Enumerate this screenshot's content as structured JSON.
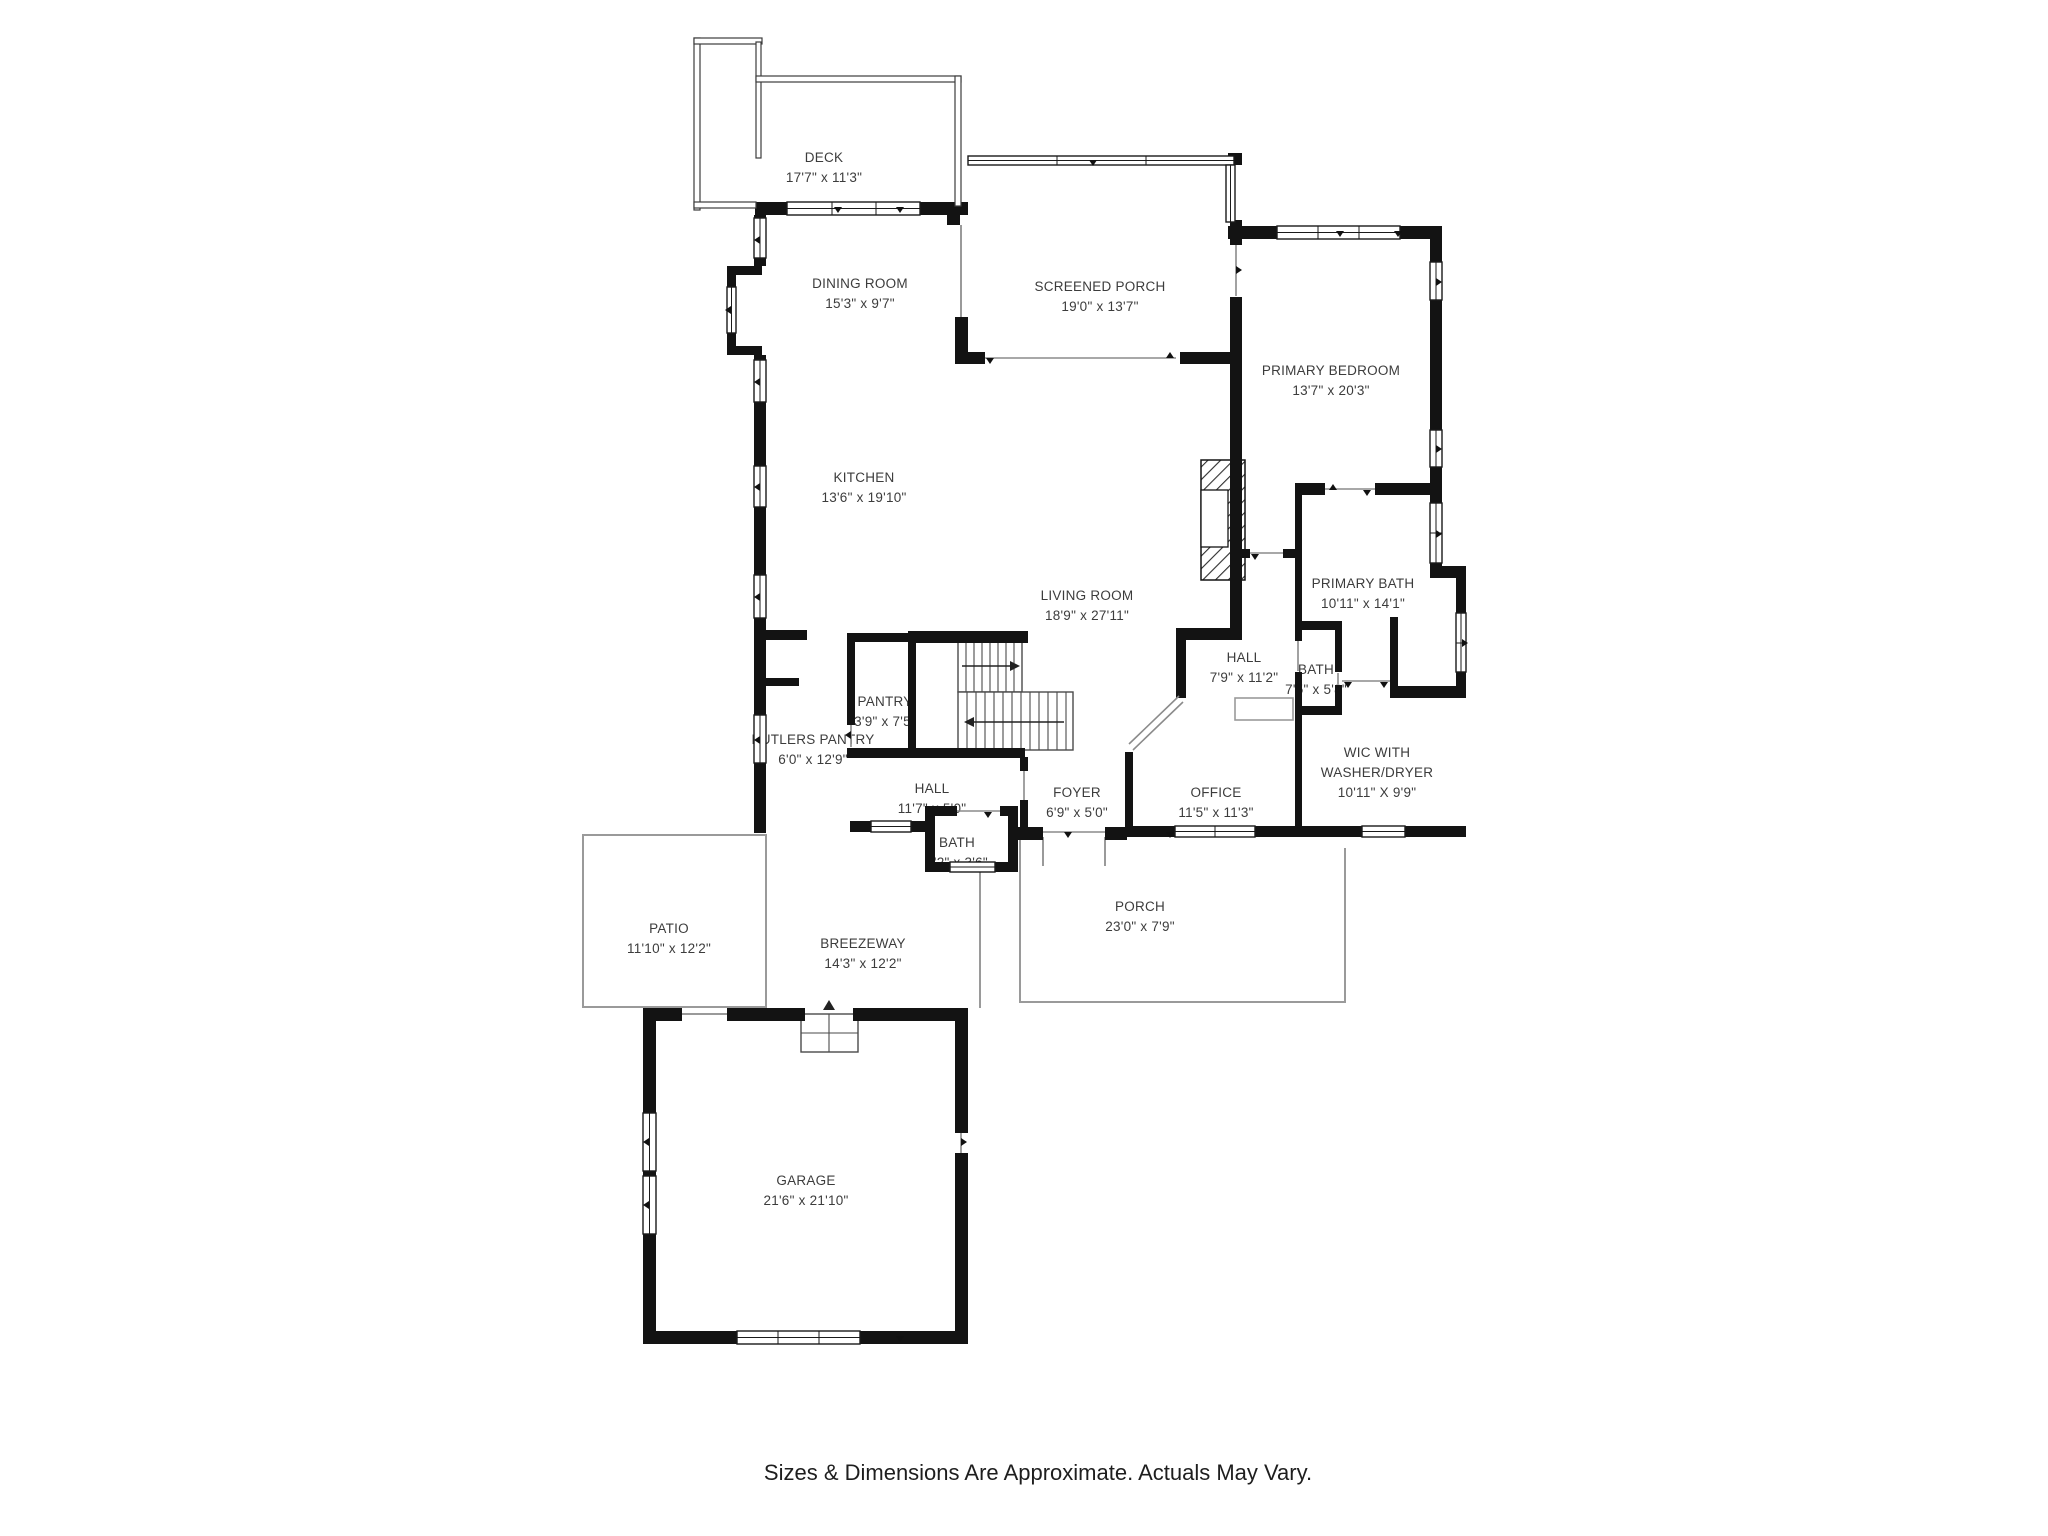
{
  "page": {
    "footer": "Sizes & Dimensions Are Approximate. Actuals May Vary.",
    "background": "#ffffff"
  },
  "colors": {
    "wall": "#131313",
    "thin_outline": "#9a9a9a",
    "label_text": "#3c3c3c",
    "footer_text": "#1e1e1e"
  },
  "rooms": [
    {
      "id": "deck",
      "label": "DECK",
      "dims": "17'7\" x 11'3\""
    },
    {
      "id": "screened-porch",
      "label": "SCREENED PORCH",
      "dims": "19'0\" x 13'7\""
    },
    {
      "id": "dining-room",
      "label": "DINING ROOM",
      "dims": "15'3\" x 9'7\""
    },
    {
      "id": "kitchen",
      "label": "KITCHEN",
      "dims": "13'6\" x 19'10\""
    },
    {
      "id": "living-room",
      "label": "LIVING ROOM",
      "dims": "18'9\" x 27'11\""
    },
    {
      "id": "primary-bedroom",
      "label": "PRIMARY BEDROOM",
      "dims": "13'7\" x 20'3\""
    },
    {
      "id": "primary-bath",
      "label": "PRIMARY BATH",
      "dims": "10'11\" x 14'1\""
    },
    {
      "id": "hall-upper",
      "label": "HALL",
      "dims": "7'9\" x 11'2\""
    },
    {
      "id": "bath-upper",
      "label": "BATH",
      "dims": "7'5\" x 5'8\""
    },
    {
      "id": "wic",
      "label": "WIC WITH",
      "label2": "WASHER/DRYER",
      "dims": "10'11\" X 9'9\""
    },
    {
      "id": "office",
      "label": "OFFICE",
      "dims": "11'5\" x 11'3\""
    },
    {
      "id": "foyer",
      "label": "FOYER",
      "dims": "6'9\" x 5'0\""
    },
    {
      "id": "hall-lower",
      "label": "HALL",
      "dims": "11'7\" x 5'0\""
    },
    {
      "id": "pantry",
      "label": "PANTRY",
      "dims": "3'9\" x 7'5\""
    },
    {
      "id": "butlers-pantry",
      "label": "BUTLERS PANTRY",
      "dims": "6'0\" x 12'9\""
    },
    {
      "id": "bath-lower",
      "label": "BATH",
      "dims": "6'2\" x 3'6\""
    },
    {
      "id": "porch",
      "label": "PORCH",
      "dims": "23'0\" x 7'9\""
    },
    {
      "id": "patio",
      "label": "PATIO",
      "dims": "11'10\" x 12'2\""
    },
    {
      "id": "breezeway",
      "label": "BREEZEWAY",
      "dims": "14'3\" x 12'2\""
    },
    {
      "id": "garage",
      "label": "GARAGE",
      "dims": "21'6\" x 21'10\""
    }
  ]
}
